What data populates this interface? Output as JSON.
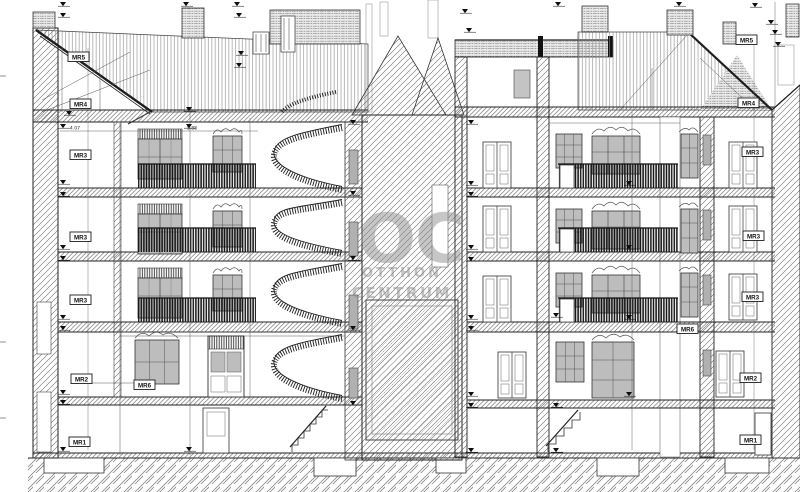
{
  "drawing": {
    "type": "building-cross-section",
    "dimension_texts": [
      "4.07",
      "5.88"
    ],
    "room_labels": [
      {
        "text": "MR5",
        "position": "left-roof"
      },
      {
        "text": "MR4",
        "position": "left-attic"
      },
      {
        "text": "MR3",
        "position": "left-floor-3"
      },
      {
        "text": "MR3",
        "position": "left-floor-2"
      },
      {
        "text": "MR3",
        "position": "left-floor-1"
      },
      {
        "text": "MR2",
        "position": "left-ground"
      },
      {
        "text": "MR1",
        "position": "left-basement"
      },
      {
        "text": "MR6",
        "position": "left-ground-hall"
      },
      {
        "text": "MR5",
        "position": "right-roof"
      },
      {
        "text": "MR4",
        "position": "right-attic"
      },
      {
        "text": "MR3",
        "position": "right-floor-3"
      },
      {
        "text": "MR3",
        "position": "right-floor-2"
      },
      {
        "text": "MR3",
        "position": "right-floor-1"
      },
      {
        "text": "MR6",
        "position": "right-ground-left"
      },
      {
        "text": "MR2",
        "position": "right-ground"
      },
      {
        "text": "MR1",
        "position": "right-basement"
      }
    ],
    "watermark": {
      "monogram": "OC",
      "line1": "OTTHON",
      "line2": "CENTRUM",
      "color": "#8f8f8f"
    },
    "colors": {
      "ink": "#2b2b2b",
      "hatch": "#6a6a6a",
      "glass": "#bdbdbd",
      "railing": "#141414",
      "paper": "#ffffff"
    }
  }
}
